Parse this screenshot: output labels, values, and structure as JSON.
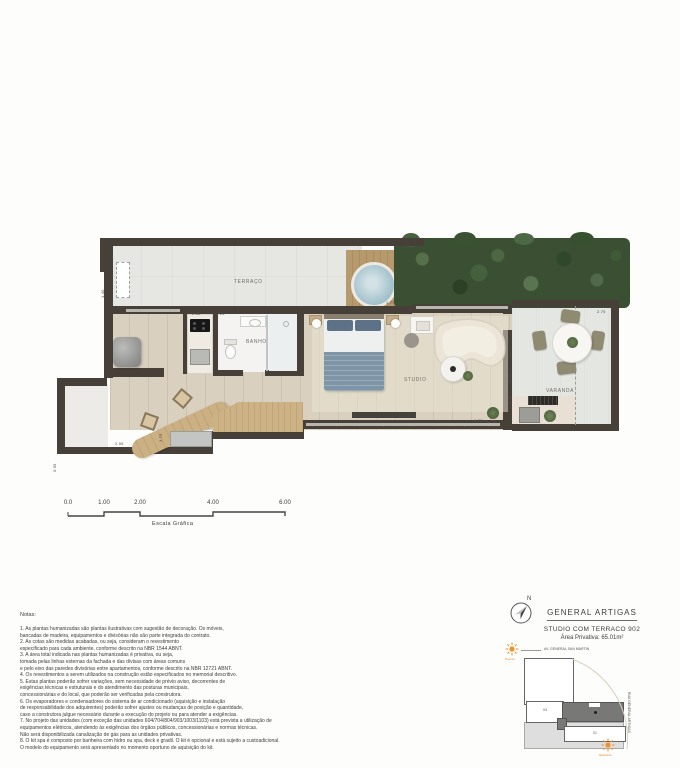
{
  "plan": {
    "room_labels": {
      "terrace": "TERRAÇO",
      "bath": "BANHO",
      "studio": "STUDIO",
      "balcony": "VARANDA"
    },
    "dimensions": {
      "kitchen": "2.65",
      "bath": "2.24",
      "spa_deck": "1.77",
      "balcony": "2.75",
      "wall_a": "3.16",
      "wall_b": "5.38",
      "studio_len": "9.33",
      "deck": "3.79",
      "bar": "2.59",
      "nook": "0.95",
      "terrace_left": "1.40"
    }
  },
  "scale_bar": {
    "ticks": [
      "0.0",
      "1.00",
      "2.00",
      "4.00",
      "6.00"
    ],
    "label": "Escala Gráfica"
  },
  "notes": {
    "heading": "Notas:",
    "lines": [
      "1. As plantas humanizadas são plantas ilustrativas com sugestão de decoração. Os móveis,",
      "bancadas de madeira, equipamentos e divisórias não são parte integrada do contrato.",
      "2. As cotas são medidas acabadas, ou seja, consideram o revestimento",
      "especificado para cada ambiente, conforme descrito na NBR 1544 ABNT.",
      "3. A área total indicada nas plantas humanizadas é privativa, ou seja,",
      "tomada pelas linhas externas da fachada e das divisas com áreas comuns",
      "e pelo eixo das paredes divisórias entre apartamentos, conforme descrito na NBR 12721 ABNT.",
      "4. Os revestimentos a serem utilizados na construção estão especificados no memorial descritivo.",
      "5. Estas plantas poderão sofrer variações, sem necessidade de prévio aviso, decorrentes de",
      "exigências técnicas e estruturais e do atendimento das posturas municipais,",
      "concessionárias e do local, que poderão ser verificadas pela construtora.",
      "6. Os evaporadores e condensadores do sistema de ar condicionado (aquisição e instalação",
      "de responsabilidade dos adquirentes) poderão sofrer ajustes ou mudanças de posição e quantidade,",
      "caso a construtora julgue necessário durante a execução do projeto ou para atender a exigências.",
      "7. No projeto das unidades (com exceção das unidades 604/704/804/903/1003/1103) está prevista a utilização de",
      "equipamentos elétricos, atendendo às exigências dos órgãos públicos, concessionárias e normas técnicas.",
      "Não será disponibilizada canalização de gás para as unidades privativas.",
      "8. O kit spa é composto por banheira com hidro ou spa, deck e gradil. O kit é opcional e está sujeito a custoadicional.",
      "O modelo do equipamento será apresentado no momento oportuno de aquisição do kit."
    ]
  },
  "title_block": {
    "project": "GENERAL ARTIGAS",
    "unit": "STUDIO COM TERRACO 902",
    "area": "Área Privativa: 65.01m²",
    "north_label": "N"
  },
  "key_map": {
    "street_top": "AV. GENERAL SAN MARTIN",
    "street_right": "RUA GENERAL ARTIGAS",
    "sun_top": "Poente",
    "sun_bottom": "Nascente",
    "unit_left": "03",
    "unit_bottom": "01"
  },
  "colors": {
    "wall": "#474039",
    "wood_floor": "#d9d0bf",
    "terrace_floor": "#e6e7e3",
    "hedge_green": "#3b4f33",
    "deck_wood": "#b69a6e",
    "spa_water": "#9fbfca",
    "sun_accent": "#e8831d",
    "highlighted_unit": "#787876",
    "blanket_blue": "#7e95a6"
  }
}
